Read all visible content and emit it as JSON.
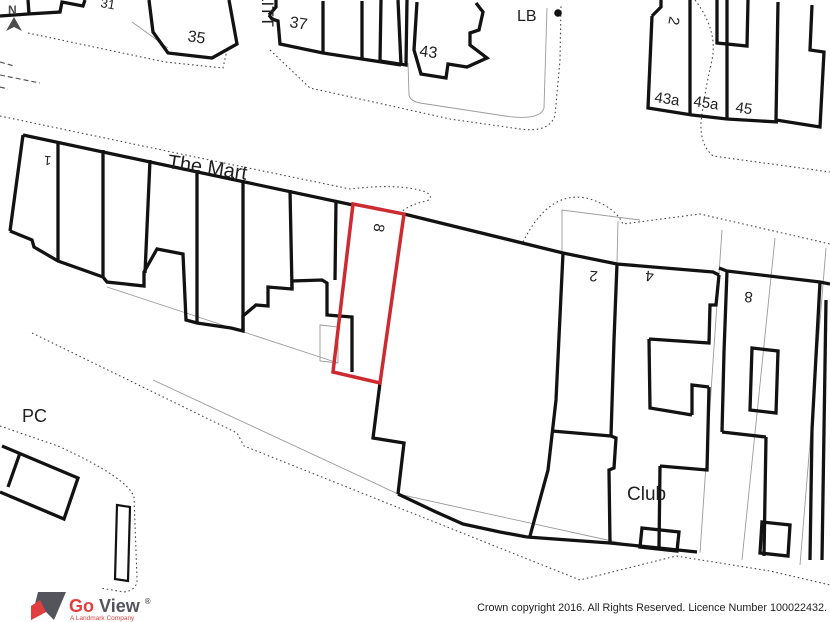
{
  "map": {
    "street": {
      "the_mart": "The Mart",
      "little": "LITT"
    },
    "labels": {
      "b31": "31",
      "b35": "35",
      "b37": "37",
      "b43": "43",
      "lb": "LB",
      "t2": "2",
      "b43a": "43a",
      "b45a": "45a",
      "b45": "45",
      "p1": "1",
      "plot8": "8",
      "r2": "2",
      "r4": "4",
      "r8": "8",
      "club": "Club",
      "pc": "PC"
    },
    "north_letter": "N",
    "plot": {
      "number": "8",
      "color": "#cc2b31"
    },
    "colors": {
      "building": "#121212",
      "thin": "#9a9a9a",
      "dotted": "#4a4a4a"
    }
  },
  "logo": {
    "go": "Go",
    "view": "View",
    "registered": "®",
    "tagline": "A Landmark Company",
    "go_color": "#e23d3f",
    "view_color": "#53545c"
  },
  "footer": {
    "copyright": "Crown copyright 2016. All Rights Reserved. Licence Number 100022432."
  }
}
